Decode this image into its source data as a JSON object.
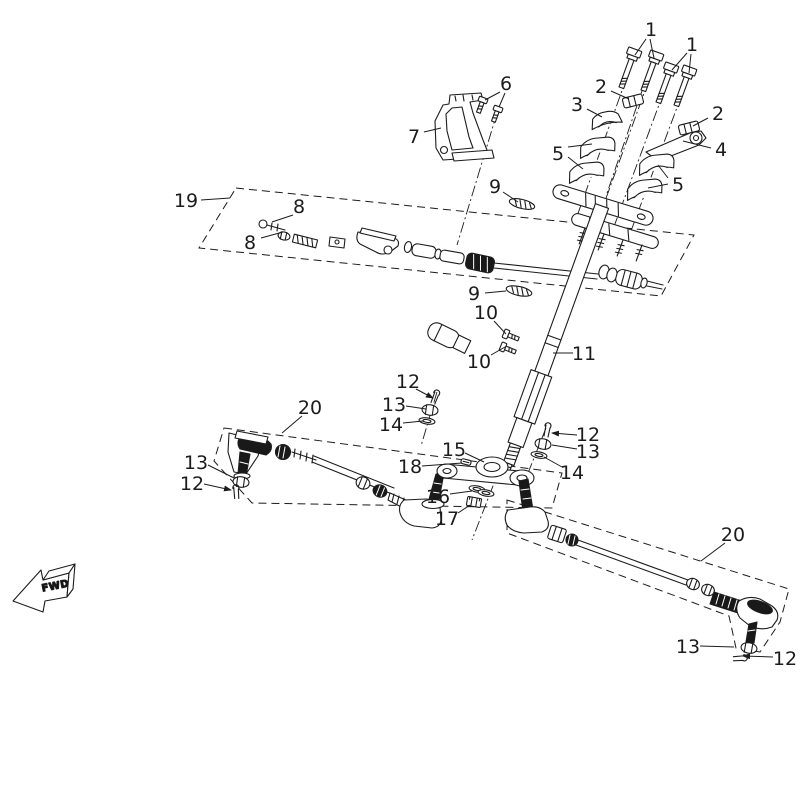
{
  "diagram": {
    "background": "#ffffff",
    "line_color": "#1c1c1c",
    "fwd_marker": {
      "label": "FWD"
    },
    "callouts": [
      {
        "label": "1",
        "x": 651,
        "y": 29,
        "leaders": [
          [
            646,
            39,
            635,
            55
          ],
          [
            650,
            39,
            654,
            58
          ]
        ]
      },
      {
        "label": "1",
        "x": 692,
        "y": 44,
        "leaders": [
          [
            687,
            53,
            672,
            70
          ],
          [
            691,
            54,
            689,
            73
          ]
        ]
      },
      {
        "label": "2",
        "x": 601,
        "y": 86,
        "leaders": [
          [
            611,
            91,
            629,
            99
          ]
        ]
      },
      {
        "label": "3",
        "x": 577,
        "y": 104,
        "leaders": [
          [
            587,
            109,
            602,
            117
          ]
        ]
      },
      {
        "label": "2",
        "x": 718,
        "y": 113,
        "leaders": [
          [
            708,
            118,
            693,
            126
          ]
        ]
      },
      {
        "label": "4",
        "x": 721,
        "y": 149,
        "leaders": [
          [
            711,
            148,
            683,
            141
          ]
        ]
      },
      {
        "label": "5",
        "x": 558,
        "y": 153,
        "leaders": [
          [
            568,
            147,
            592,
            144
          ],
          [
            568,
            157,
            583,
            169
          ]
        ]
      },
      {
        "label": "5",
        "x": 678,
        "y": 184,
        "leaders": [
          [
            668,
            178,
            658,
            165
          ],
          [
            668,
            184,
            648,
            188
          ]
        ]
      },
      {
        "label": "6",
        "x": 506,
        "y": 83,
        "leaders": [
          [
            500,
            92,
            485,
            100
          ],
          [
            505,
            93,
            499,
            107
          ]
        ]
      },
      {
        "label": "7",
        "x": 414,
        "y": 136,
        "leaders": [
          [
            424,
            132,
            441,
            128
          ]
        ]
      },
      {
        "label": "9",
        "x": 495,
        "y": 186,
        "leaders": [
          [
            503,
            192,
            518,
            202
          ]
        ]
      },
      {
        "label": "19",
        "x": 186,
        "y": 200,
        "leaders": [
          [
            201,
            200,
            230,
            198
          ]
        ]
      },
      {
        "label": "8",
        "x": 299,
        "y": 206,
        "leaders": [
          [
            293,
            215,
            272,
            222
          ]
        ]
      },
      {
        "label": "8",
        "x": 250,
        "y": 242,
        "leaders": [
          [
            261,
            238,
            283,
            232
          ]
        ]
      },
      {
        "label": "9",
        "x": 474,
        "y": 293,
        "leaders": [
          [
            485,
            293,
            506,
            291
          ]
        ]
      },
      {
        "label": "10",
        "x": 486,
        "y": 312,
        "leaders": [
          [
            494,
            321,
            506,
            334
          ]
        ]
      },
      {
        "label": "10",
        "x": 479,
        "y": 361,
        "leaders": [
          [
            491,
            355,
            505,
            347
          ]
        ]
      },
      {
        "label": "11",
        "x": 584,
        "y": 353,
        "leaders": [
          [
            573,
            353,
            553,
            353
          ]
        ]
      },
      {
        "label": "12",
        "x": 408,
        "y": 381,
        "arrow": true,
        "leaders": [
          [
            416,
            389,
            433,
            398
          ]
        ]
      },
      {
        "label": "13",
        "x": 394,
        "y": 404,
        "leaders": [
          [
            406,
            406,
            426,
            409
          ]
        ]
      },
      {
        "label": "14",
        "x": 391,
        "y": 424,
        "leaders": [
          [
            403,
            423,
            423,
            421
          ]
        ]
      },
      {
        "label": "20",
        "x": 310,
        "y": 407,
        "leaders": [
          [
            302,
            416,
            282,
            433
          ]
        ]
      },
      {
        "label": "13",
        "x": 196,
        "y": 462,
        "leaders": [
          [
            208,
            465,
            234,
            478
          ]
        ]
      },
      {
        "label": "12",
        "x": 192,
        "y": 483,
        "arrow": true,
        "leaders": [
          [
            204,
            484,
            231,
            490
          ]
        ]
      },
      {
        "label": "15",
        "x": 454,
        "y": 449,
        "leaders": [
          [
            465,
            453,
            484,
            462
          ]
        ]
      },
      {
        "label": "18",
        "x": 410,
        "y": 466,
        "leaders": [
          [
            422,
            466,
            462,
            463
          ]
        ]
      },
      {
        "label": "12",
        "x": 588,
        "y": 434,
        "arrow": true,
        "leaders": [
          [
            577,
            435,
            552,
            433
          ]
        ]
      },
      {
        "label": "13",
        "x": 588,
        "y": 451,
        "leaders": [
          [
            577,
            449,
            552,
            445
          ]
        ]
      },
      {
        "label": "14",
        "x": 572,
        "y": 472,
        "leaders": [
          [
            562,
            467,
            544,
            457
          ]
        ]
      },
      {
        "label": "16",
        "x": 438,
        "y": 496,
        "leaders": [
          [
            450,
            494,
            472,
            491
          ]
        ]
      },
      {
        "label": "17",
        "x": 447,
        "y": 518,
        "leaders": [
          [
            458,
            513,
            470,
            505
          ]
        ]
      },
      {
        "label": "20",
        "x": 733,
        "y": 534,
        "leaders": [
          [
            725,
            543,
            701,
            561
          ]
        ]
      },
      {
        "label": "13",
        "x": 688,
        "y": 646,
        "leaders": [
          [
            700,
            646,
            734,
            647
          ]
        ]
      },
      {
        "label": "12",
        "x": 785,
        "y": 658,
        "arrow": true,
        "leaders": [
          [
            773,
            657,
            743,
            656
          ]
        ]
      }
    ]
  }
}
